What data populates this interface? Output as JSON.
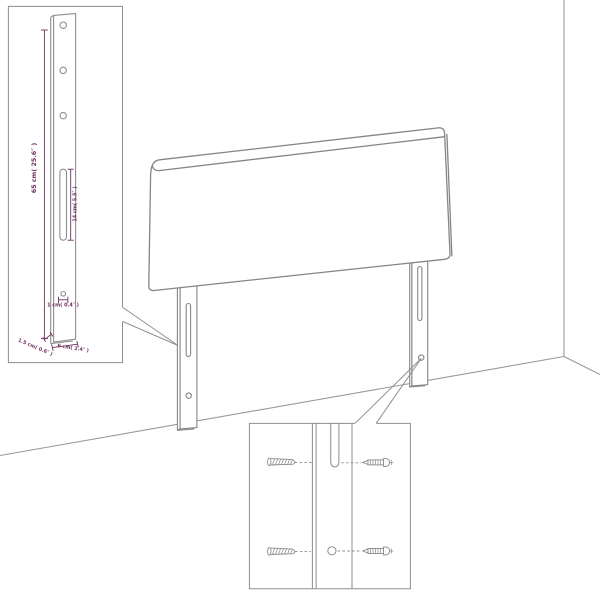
{
  "diagram": {
    "background": "#ffffff",
    "line_color": "#8a8a8a",
    "dimension_color": "#703060",
    "dimensions": {
      "height": "65 cm( 25.6″ )",
      "slot_length": "14 cm( 5.5″ )",
      "hole": "1 cm( 0.4″ )",
      "thickness": "1.5 cm( 0.6″ )",
      "width": "6 cm( 2.4″ )"
    },
    "icons": {
      "screw": "screw-icon",
      "wall_plug": "wall-plug-icon"
    }
  }
}
